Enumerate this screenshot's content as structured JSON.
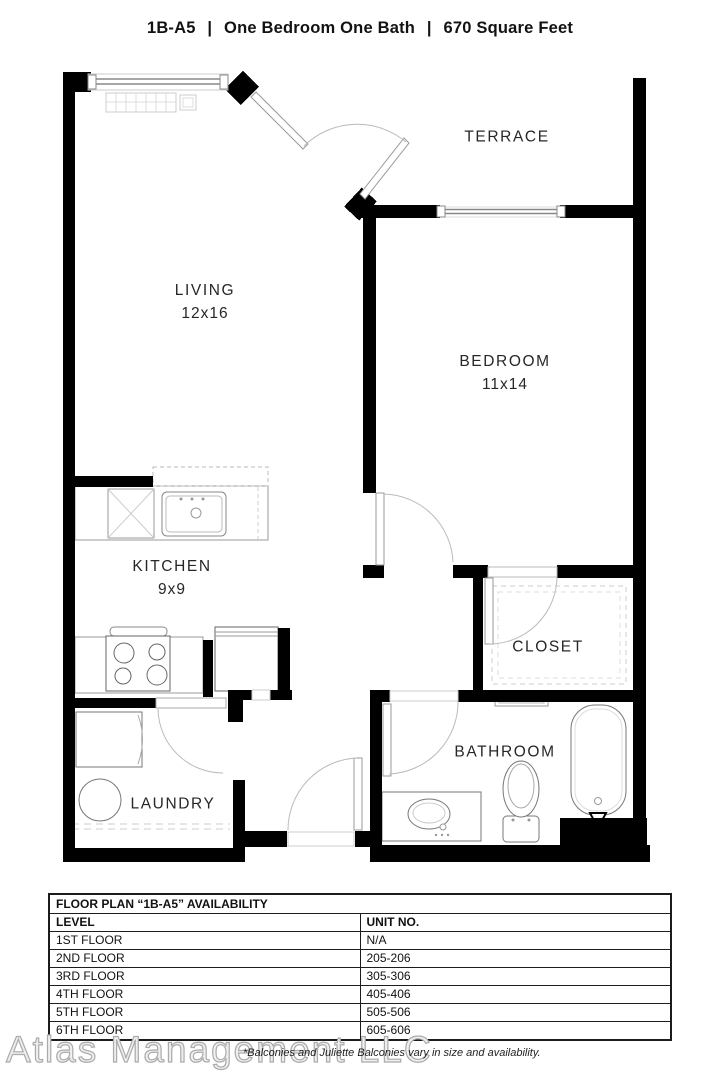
{
  "title": {
    "code": "1B-A5",
    "separator": "|",
    "type": "One Bedroom One Bath",
    "area": "670 Square Feet"
  },
  "rooms": {
    "living": {
      "name": "LIVING",
      "dims": "12x16"
    },
    "bedroom": {
      "name": "BEDROOM",
      "dims": "11x14"
    },
    "kitchen": {
      "name": "KITCHEN",
      "dims": "9x9"
    },
    "terrace": {
      "name": "TERRACE"
    },
    "closet": {
      "name": "CLOSET"
    },
    "bathroom": {
      "name": "BATHROOM"
    },
    "laundry": {
      "name": "LAUNDRY"
    }
  },
  "availability_table": {
    "title": "FLOOR PLAN “1B-A5” AVAILABILITY",
    "columns": [
      "LEVEL",
      "UNIT NO."
    ],
    "rows": [
      {
        "level": "1ST FLOOR",
        "unit": "N/A"
      },
      {
        "level": "2ND FLOOR",
        "unit": "205-206"
      },
      {
        "level": "3RD FLOOR",
        "unit": "305-306"
      },
      {
        "level": "4TH FLOOR",
        "unit": "405-406"
      },
      {
        "level": "5TH FLOOR",
        "unit": "505-506"
      },
      {
        "level": "6TH FLOOR",
        "unit": "605-606"
      }
    ]
  },
  "footer": {
    "watermark": "Atlas Management LLC",
    "note": "*Balconies and Juliette Balconies vary in size and availability."
  },
  "colors": {
    "wall": "#000000",
    "fixture_line": "#777777",
    "light_line": "#bbbbbb",
    "text": "#1a1a1a"
  }
}
